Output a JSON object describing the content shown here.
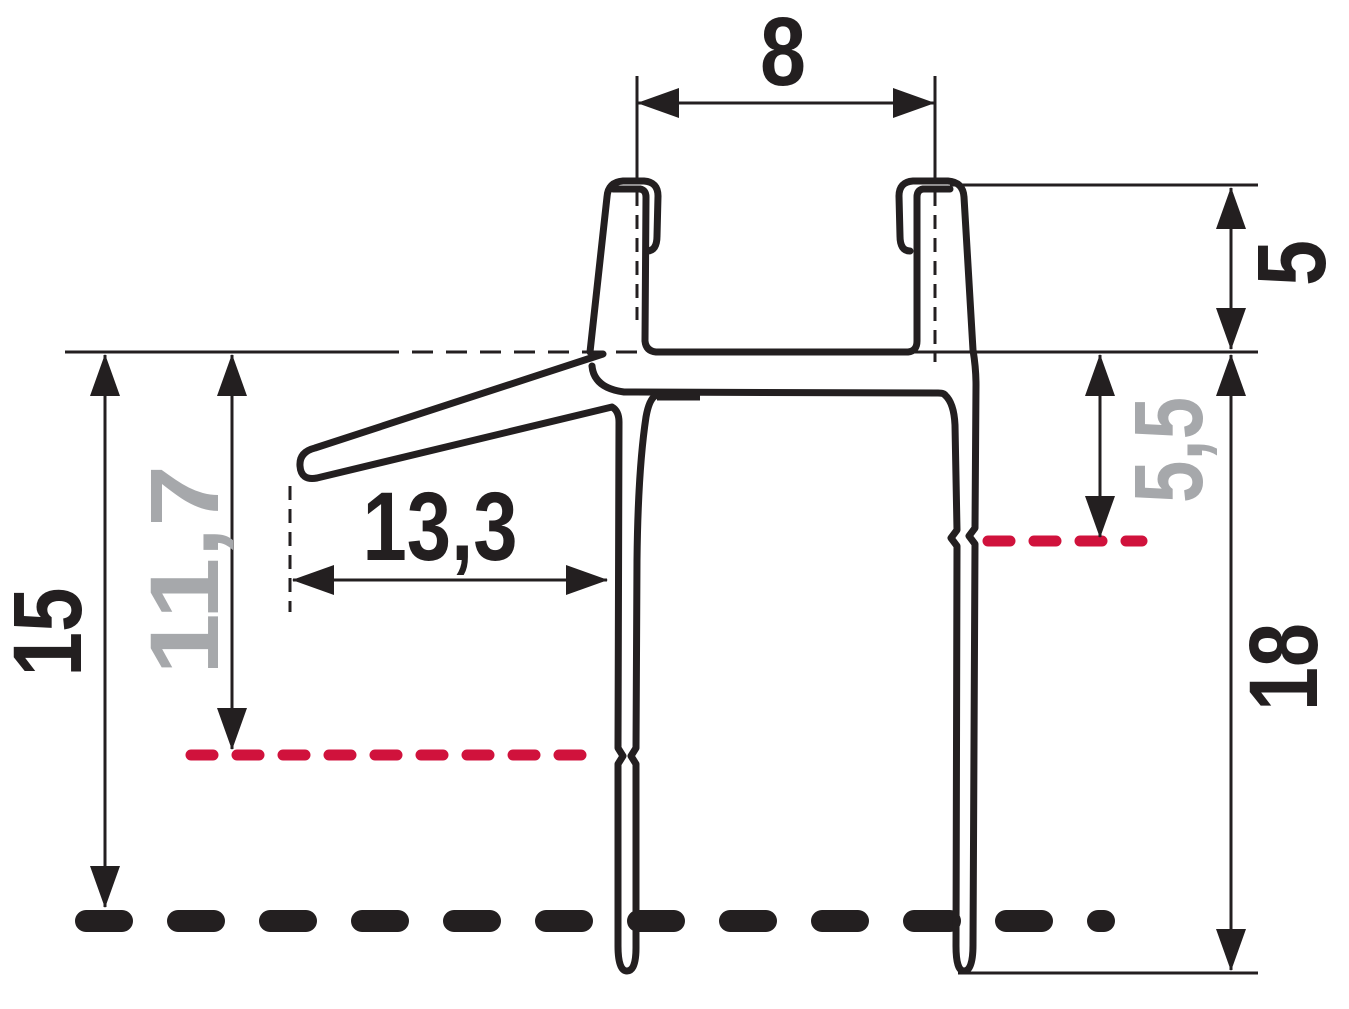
{
  "colors": {
    "ink": "#231f20",
    "highlight_red": "#d0123c",
    "muted_gray": "#a6a8ab",
    "background": "#ffffff"
  },
  "dimensions": {
    "top_width": "8",
    "right_upper_height": "5",
    "right_mid_height": "5,5",
    "right_lower_height": "18",
    "left_height": "15",
    "left_mid_height": "11,7",
    "center_width": "13,3"
  }
}
